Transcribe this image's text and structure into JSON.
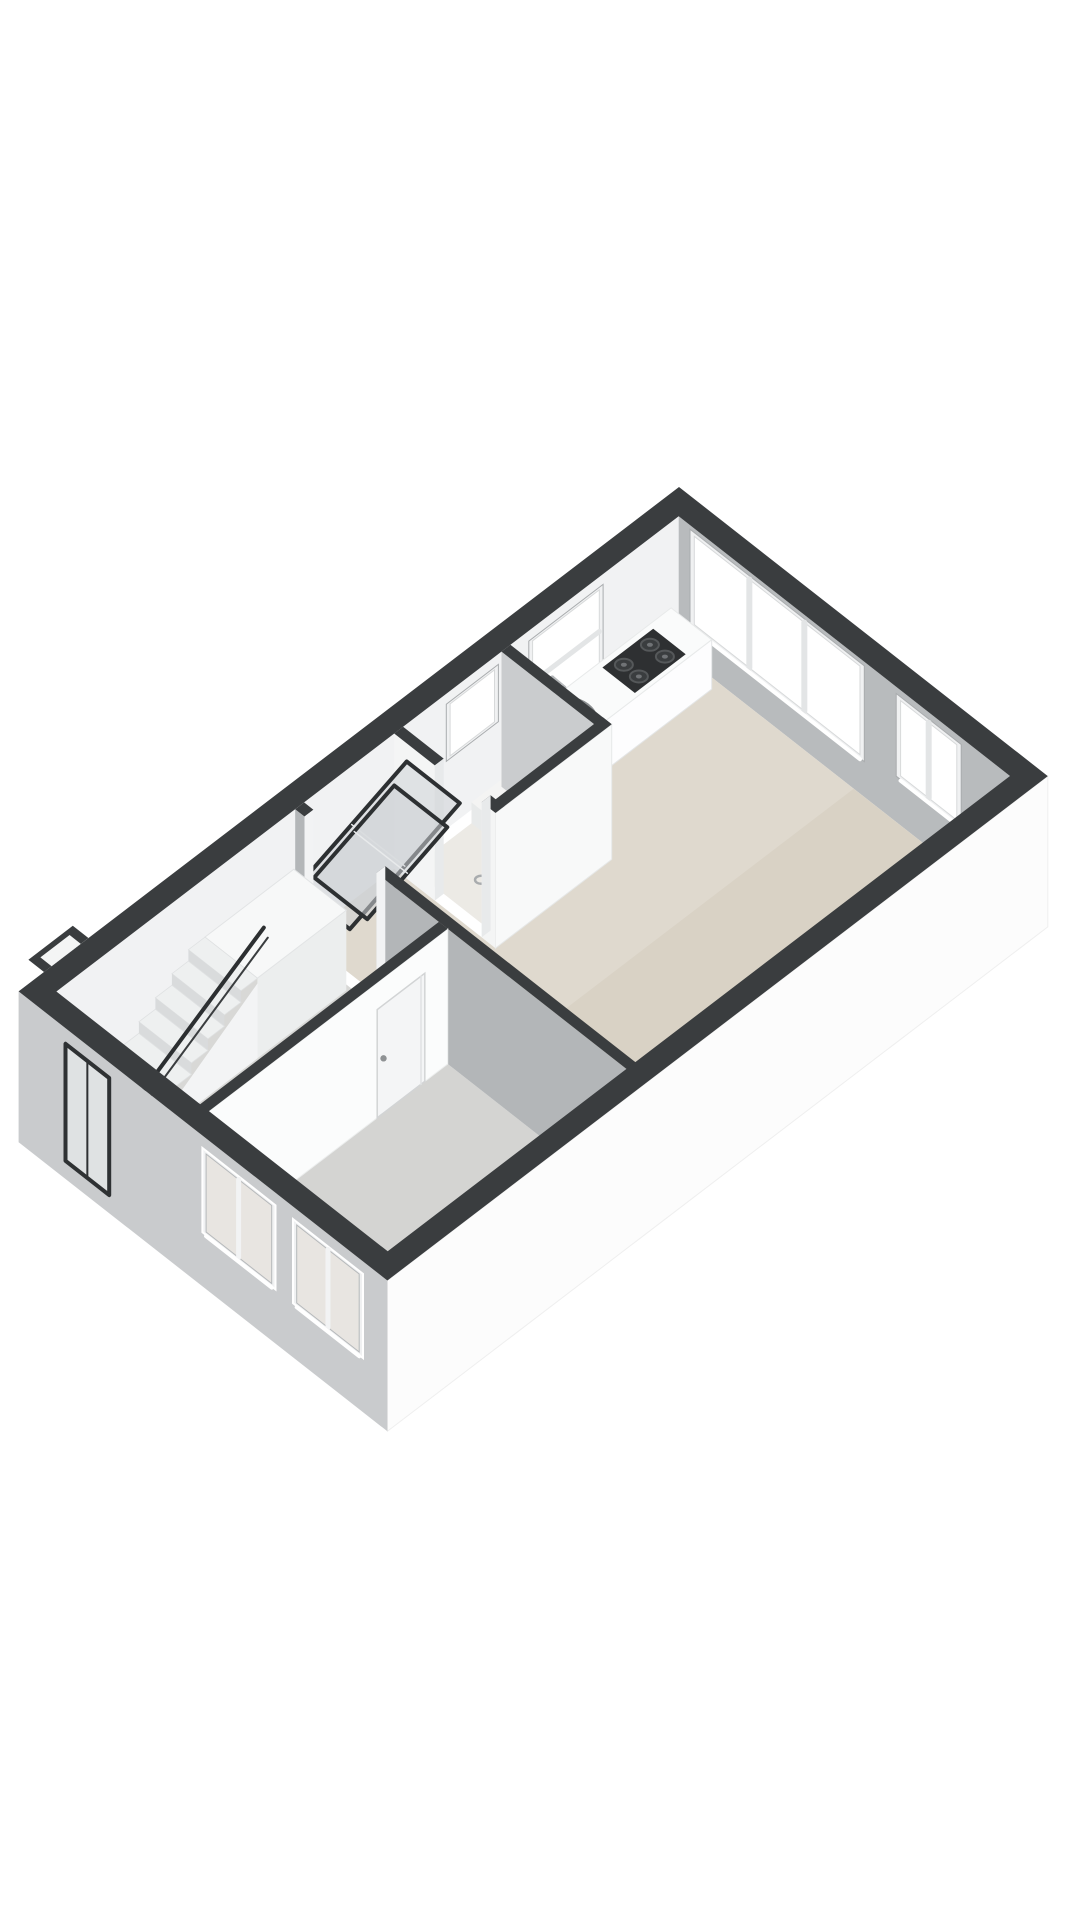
{
  "scene": {
    "kind": "3d-floor-plan-render",
    "background": "#ffffff"
  },
  "projection": {
    "origin": [
      679,
      487
    ],
    "u_axis": [
      -63.5,
      48.5
    ],
    "v_axis": [
      62.5,
      49.0
    ],
    "z_scale": 52,
    "wall_top": 2.6
  },
  "building": {
    "outer_u": 10.4,
    "outer_v": 5.9,
    "exterior_wall": 0.3,
    "interior_wall": 0.14,
    "wall_height": 2.6,
    "slab_below": -0.3,
    "entry_jog": {
      "u1": 9.3,
      "u2": 10.0,
      "v_out": -0.25
    }
  },
  "palette": {
    "wall_top_band": "#3a3d3f",
    "ext_face_se": "#fcfcfc",
    "ext_face_sw": "#c9cbcd",
    "int_face_nw": "#f1f2f3",
    "int_face_ne": "#b8bbbd",
    "int_face_white": "#f8f9f9",
    "int_face_gray": "#b3b6b8",
    "floor_living": "#d9d2c5",
    "floor_living_light": "#e4ddd0",
    "floor_hall": "#d8d8d6",
    "floor_bedroom": "#d4d4d2",
    "floor_bathroom": "#e9e6e1",
    "window_glass": "#ffffff",
    "window_frame": "#f0f1f2",
    "window_frame_edge": "#a9acae",
    "pane_exterior": "#e8e5e1",
    "hob_dark": "#2e3032",
    "burner": "#55585a",
    "chrome": "#b4b7b9",
    "railing": "#2c2f31",
    "glass_panel_stroke": "#2d3032",
    "glass_panel_fill": "rgba(205,210,213,0.55)",
    "door_leaf": "#f4f5f6",
    "front_door_frame": "#2e3133"
  },
  "rooms": [
    {
      "name": "living-kitchen",
      "floor": "floor_living",
      "poly": [
        [
          0.3,
          0.3
        ],
        [
          2.95,
          0.3
        ],
        [
          2.95,
          1.92
        ],
        [
          4.78,
          1.92
        ],
        [
          4.78,
          0.3
        ],
        [
          6.2,
          0.3
        ],
        [
          6.2,
          5.75
        ],
        [
          0.3,
          5.75
        ]
      ]
    },
    {
      "name": "hall",
      "floor": "floor_hall",
      "poly": [
        [
          6.34,
          0.3
        ],
        [
          10.25,
          0.3
        ],
        [
          10.25,
          2.6
        ],
        [
          6.34,
          2.6
        ]
      ]
    },
    {
      "name": "bedroom",
      "floor": "floor_bedroom",
      "poly": [
        [
          6.34,
          2.74
        ],
        [
          10.25,
          2.74
        ],
        [
          10.25,
          5.75
        ],
        [
          6.34,
          5.75
        ]
      ]
    },
    {
      "name": "bathroom",
      "floor": "floor_bathroom",
      "poly": [
        [
          3.09,
          0.44
        ],
        [
          4.64,
          0.44
        ],
        [
          4.64,
          1.78
        ],
        [
          3.09,
          1.78
        ]
      ]
    }
  ],
  "windows_ne_wall": [
    {
      "name": "window-living-large",
      "v1": 0.55,
      "v2": 3.2,
      "z1": 0.75,
      "z2": 2.45,
      "mullions_v": [
        1.43,
        2.31
      ]
    },
    {
      "name": "window-living-small",
      "v1": 3.85,
      "v2": 4.75,
      "z1": 0.95,
      "z2": 2.4,
      "mullions_v": [
        4.3
      ]
    }
  ],
  "windows_nw_wall": [
    {
      "name": "window-kitchen",
      "u1": 1.55,
      "u2": 2.6,
      "z1": 0.9,
      "z2": 2.35,
      "mullion_z": 1.55
    },
    {
      "name": "window-bathroom",
      "u1": 3.2,
      "u2": 3.9,
      "z1": 1.35,
      "z2": 2.35,
      "mullion_z": null
    }
  ],
  "windows_sw_wall": [
    {
      "name": "window-bedroom-1",
      "v1": 3.0,
      "v2": 4.05,
      "z1": 0.8,
      "z2": 2.3,
      "mullion_v": 3.52
    },
    {
      "name": "window-bedroom-2",
      "v1": 4.45,
      "v2": 5.45,
      "z1": 0.8,
      "z2": 2.3,
      "mullion_v": 4.95
    }
  ],
  "front_door": {
    "name": "front-door-glass",
    "v1": 0.75,
    "v2": 1.45,
    "z1": 0.05,
    "z2": 2.3
  },
  "kitchen": {
    "counter": {
      "u1": 0.42,
      "u2": 2.95,
      "v1": 0.3,
      "v2": 0.95,
      "height": 0.95
    },
    "hob": {
      "u1": 0.78,
      "u2": 1.58,
      "v1": 0.38,
      "v2": 0.9,
      "burners": [
        [
          0.97,
          0.52
        ],
        [
          0.97,
          0.76
        ],
        [
          1.38,
          0.52
        ],
        [
          1.38,
          0.76
        ]
      ]
    },
    "sink": {
      "u": 2.32,
      "v": 0.62,
      "r_outer": 26,
      "r_inner": 18
    },
    "faucet": {
      "u": 2.32,
      "v": 0.33
    }
  },
  "bathroom_block": {
    "ne_wall": {
      "u1": 2.95,
      "u2": 3.09,
      "v1": 0.3,
      "v2": 1.92
    },
    "se_wall": {
      "v1": 1.78,
      "v2": 1.92,
      "u1": 2.95,
      "u2": 4.78
    },
    "sw_wall_segs": [
      {
        "v1": 0.3,
        "v2": 0.95
      },
      {
        "v1": 1.7,
        "v2": 1.92
      }
    ],
    "sw_wall_u1": 4.64,
    "sw_wall_u2": 4.78,
    "tray": {
      "u1": 3.09,
      "u2": 3.7,
      "v1": 0.44,
      "v2": 1.78,
      "height": 0.4
    },
    "drain": {
      "u": 4.2,
      "v": 1.1
    },
    "glass_panels": [
      {
        "name": "glass-panel-upper",
        "hinge": [
          [
            4.78,
            0.5,
            2.25
          ],
          [
            4.78,
            1.35,
            2.25
          ]
        ],
        "offset": [
          -110,
          126
        ]
      },
      {
        "name": "glass-panel-lower",
        "hinge": [
          [
            4.78,
            0.3,
            1.6
          ],
          [
            4.78,
            1.15,
            1.6
          ]
        ],
        "offset": [
          -80,
          92
        ]
      }
    ]
  },
  "interior_walls": {
    "w3_living_hall": {
      "u1": 6.2,
      "u2": 6.34,
      "segs_v": [
        [
          0.3,
          0.45
        ],
        [
          1.6,
          5.75
        ]
      ]
    },
    "hall_bedroom": {
      "v1": 2.6,
      "v2": 2.74,
      "u1": 6.34,
      "u2": 10.25
    }
  },
  "bedroom_door": {
    "u1": 6.7,
    "u2": 7.45,
    "z1": 0.0,
    "z2": 2.08,
    "handle_u": 7.35,
    "handle_z": 1.05
  },
  "chimney": {
    "u1": 3.95,
    "u2": 4.6,
    "v1": 5.28,
    "v2": 5.75,
    "height": 0.85
  },
  "stairs": {
    "v1": 0.34,
    "v2": 1.18,
    "u_bottom": 9.62,
    "steps": 7,
    "run": 0.26,
    "rise": 0.22,
    "landing": {
      "u1": 6.4,
      "u2": 7.8,
      "z": 1.54
    },
    "railing": {
      "p1": [
        9.7,
        1.18,
        0.98
      ],
      "p2": [
        7.7,
        1.18,
        2.42
      ],
      "newel_z": 0.98,
      "tail_u": 10.08,
      "tail_z": 0.8
    }
  },
  "floor_light_overlay": {
    "poly": [
      [
        0.3,
        0.3
      ],
      [
        6.2,
        0.3
      ],
      [
        6.2,
        3.1
      ],
      [
        0.3,
        3.1
      ]
    ],
    "opacity": 0.16
  }
}
